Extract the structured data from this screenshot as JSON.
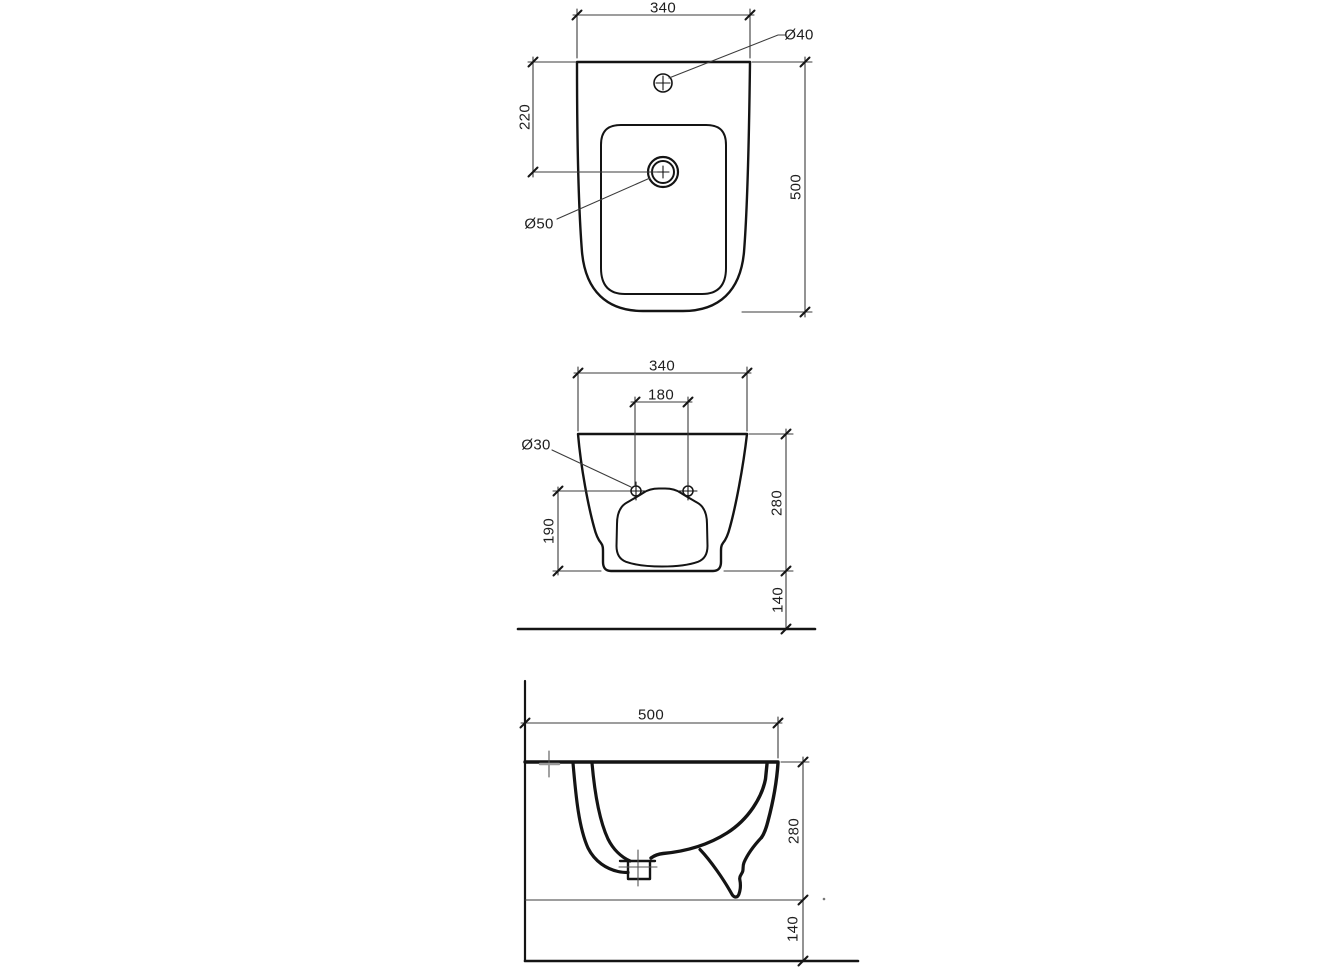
{
  "drawing": {
    "kind": "sanitary-ware technical drawing, three orthographic views of a wall-hung bidet",
    "background_color": "#ffffff",
    "outline_color": "#141414",
    "dimension_line_color": "#3b3b3b"
  },
  "views": {
    "top": {
      "dimensions": {
        "overall_width": "340",
        "tap_hole_diameter": "Ø40",
        "drain_offset_from_back": "220",
        "drain_diameter": "Ø50",
        "overall_depth": "500"
      }
    },
    "front": {
      "dimensions": {
        "overall_width": "340",
        "fixing_hole_spacing": "180",
        "fixing_hole_diameter": "Ø30",
        "lower_edge_height": "190",
        "body_height": "280",
        "floor_clearance": "140"
      }
    },
    "side": {
      "dimensions": {
        "overall_depth": "500",
        "body_height": "280",
        "floor_clearance": "140"
      }
    }
  }
}
